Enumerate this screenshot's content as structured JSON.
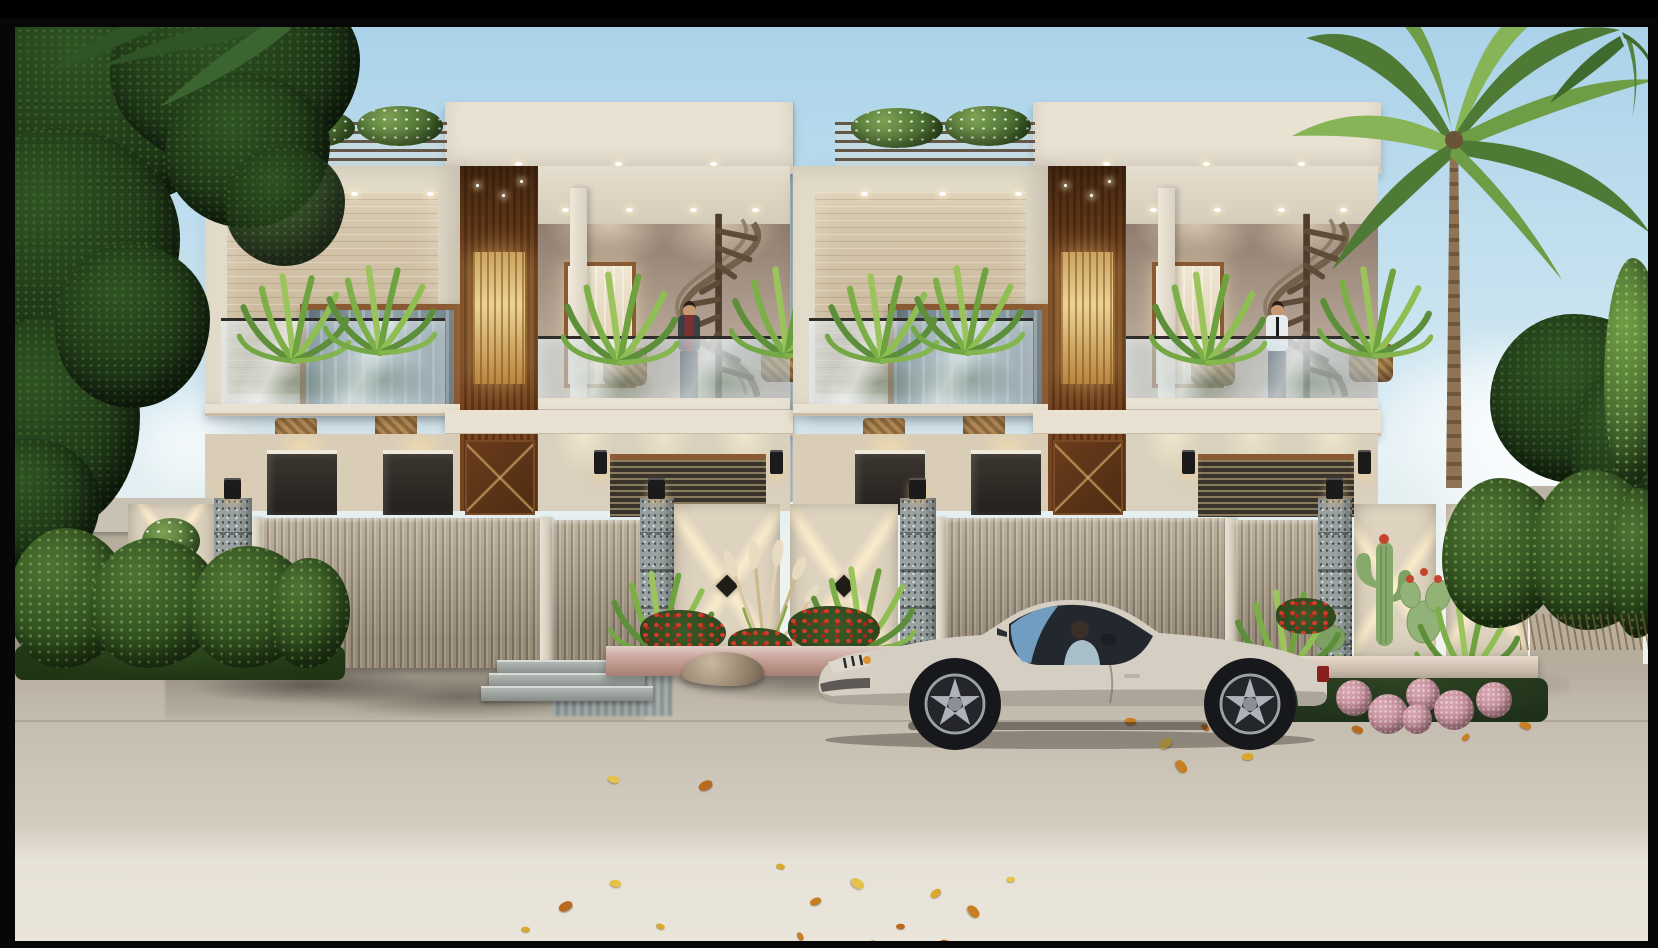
{
  "meta": {
    "type": "architectural-exterior-render",
    "subject": "Twin modern duplex villas with compound wall, landscaped frontage, wet road and parked sports coupe",
    "width_px": 1658,
    "height_px": 930,
    "visible_text": "none"
  },
  "colors": {
    "sky-top": "#a9d2e9",
    "sky-mid": "#cfe6f1",
    "sky-horizon": "#edf3f1",
    "cream-roof": "#e9e1d1",
    "cream-wall": "#e3dbc9",
    "cream-ground": "#d9cdb7",
    "travertine-1": "#d8cbb2",
    "travertine-2": "#c3b091",
    "wood-dark": "#5a3316",
    "wood-mid": "#76451f",
    "wood-frame": "#8a5a33",
    "interior-wall": "#8f7e6f",
    "interior-wall-2": "#b3a293",
    "glass-dark": "#5f6f78",
    "stone-1": "#d9d0bd",
    "gate-light": "#b7aa93",
    "gate-dark": "#8e8270",
    "pillar-granite": "#99a1a1",
    "post-white": "#e8e2d4",
    "panel-cream": "#ded3bf",
    "diamond-dark": "#201d18",
    "lamp-black": "#1b1b1b",
    "wall-grey": "#b6ad9d",
    "wall-cap": "#c8c2b4",
    "hedge-dark": "#2c4a22",
    "hedge-mid": "#3f612e",
    "fern-light": "#9cc45c",
    "fern-dark": "#5d8f3a",
    "palm-1": "#4f7a35",
    "palm-2": "#7fae4e",
    "trunk-brown": "#8e7355",
    "road-1": "#b5ac9e",
    "road-2": "#cfc8ba",
    "road-3": "#ded8cc",
    "wet": "#847c70",
    "car-body": "#d5cec2",
    "car-glass": "#23282e",
    "car-blue": "#7fb3d9",
    "wheel": "#17181c",
    "rim": "#adb3b8",
    "tail-red": "#8a1f1f",
    "flower-red": "#d23b28",
    "pompom-pink": "#c08794",
    "planter-pink": "#c9a59b",
    "skin": "#c89a74",
    "shirt-white": "#e9ecee",
    "shirt-maroon": "#7c3030",
    "pants": "#33343c",
    "tie": "#1a1a1a",
    "frame-black": "#070707"
  },
  "scene": {
    "sky": {
      "label": "clear pale-blue sky with soft clouds near the horizon"
    },
    "houses": [
      {
        "label": "left-house",
        "person": {
          "pose": "standing on first-floor balcony",
          "outfit": "dark jacket over maroon shirt"
        },
        "features": [
          "roof pergola with shrubs",
          "travertine feature wall",
          "wood-framed picture window",
          "glass balcony with ferns",
          "recessed terrace with downlights",
          "spiral staircase",
          "golden backlit entry panel",
          "stone-clad ground floor",
          "wooden X-pattern door"
        ]
      },
      {
        "label": "right-house",
        "person": {
          "pose": "standing on first-floor balcony",
          "outfit": "white shirt with black tie"
        },
        "features": [
          "roof pergola with shrubs",
          "travertine feature wall",
          "wood-framed picture window",
          "glass balcony with ferns",
          "recessed terrace with downlights",
          "spiral staircase",
          "golden backlit entry panel",
          "stone-clad ground floor",
          "wooden X-pattern door"
        ]
      }
    ],
    "boundary": {
      "wall": "grey-beige plastered wall with cap band",
      "pillars": 4,
      "pillar_material": "speckled granite with box lamps on top",
      "gates": [
        {
          "label": "left-main-gate",
          "style": "beige vertical slats"
        },
        {
          "label": "left-pedestrian-gate",
          "style": "beige vertical slats"
        },
        {
          "label": "right-main-gate",
          "style": "beige vertical slats"
        },
        {
          "label": "right-pedestrian-gate",
          "style": "beige vertical slats"
        }
      ],
      "ornament": "cream panels with crossing light beams and black diamond medallions",
      "extras": [
        "stacked topiary panel left",
        "cacti feature panels right",
        "entry steps at left pedestrian gate"
      ]
    },
    "vehicle": {
      "label": "silver-grey muscle coupe",
      "facing": "left",
      "occupant": "driver seated at wheel",
      "details": [
        "blue windshield reflection",
        "five-spoke alloy wheels",
        "amber headlight",
        "red tail lamp"
      ]
    },
    "landscaping": [
      "large shade tree left",
      "boundary hedges",
      "balcony ferns in woven pots",
      "pampas grass",
      "red flower bed",
      "cacti bed",
      "pink pompom flowers",
      "tall royal palm right",
      "white-flowering roof shrubs"
    ],
    "road": {
      "surface": "wet beige concrete",
      "details": [
        "dark water patches by gates",
        "reflections",
        "scattered yellow autumn leaves"
      ]
    }
  }
}
